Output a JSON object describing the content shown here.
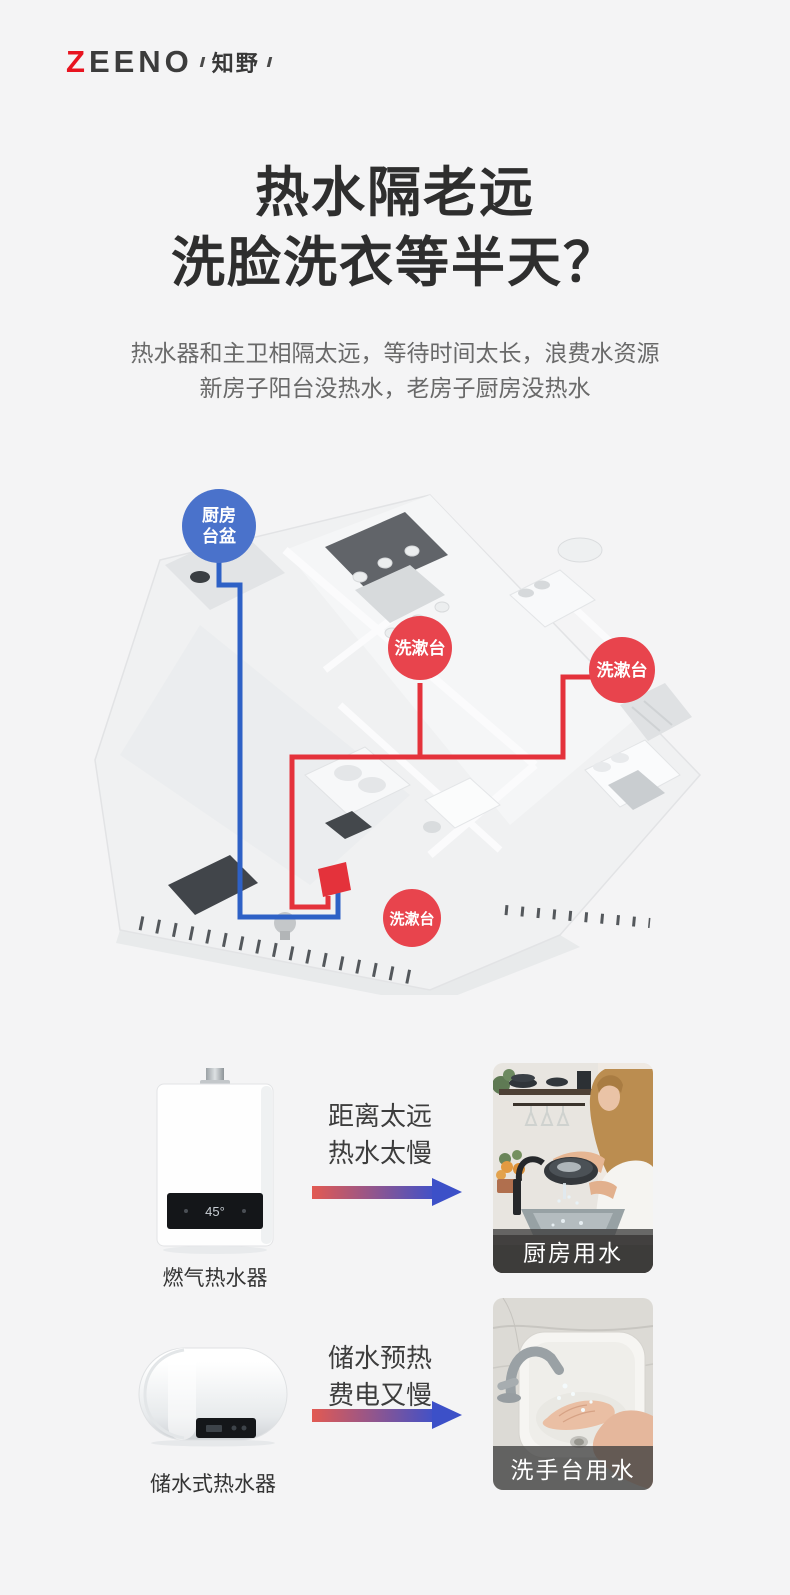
{
  "brand": {
    "logo_z": "Z",
    "logo_rest": "EENO",
    "logo_sub": "知野",
    "accent_red": "#e81420"
  },
  "hero": {
    "title": [
      "热水隔老远",
      "洗脸洗衣等半天？"
    ],
    "subtitle": [
      "热水器和主卫相隔太远，等待时间太长，浪费水资源",
      "新房子阳台没热水，老房子厨房没热水"
    ]
  },
  "floorplan": {
    "kitchen_label": [
      "厨房",
      "台盆"
    ],
    "washbasin_label": "洗漱台",
    "colors": {
      "cold_pipe_blue": "#2e61c6",
      "hot_pipe_red": "#e4323b",
      "kitchen_badge_blue": "#4a72cb",
      "washbasin_badge_red": "#e8444d"
    }
  },
  "comparison": {
    "arrow_gradient": [
      "#e25a52",
      "#3f51c9"
    ],
    "rows": [
      {
        "product_label": "燃气热水器",
        "display_value": "45°",
        "problem": [
          "距离太远",
          "热水太慢"
        ],
        "photo_label": "厨房用水"
      },
      {
        "product_label": "储水式热水器",
        "problem": [
          "储水预热",
          "费电又慢"
        ],
        "photo_label": "洗手台用水"
      }
    ]
  }
}
